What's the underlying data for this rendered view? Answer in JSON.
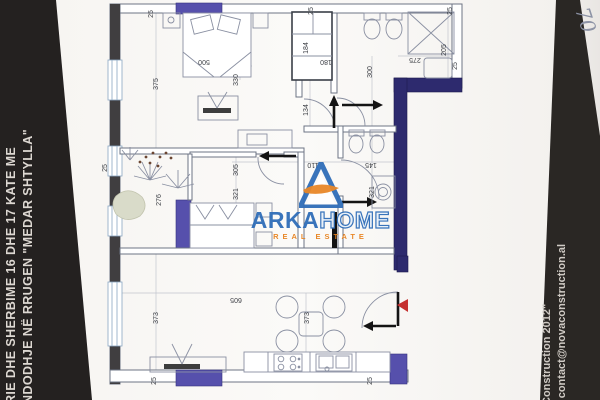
{
  "left_banner": {
    "line1": "RIE DHE SHERBIME 16 DHE 17 KATE ME",
    "line2": "NDODHJE NË RRUGEN \"MEDAR SHTYLLA\""
  },
  "right_banner": {
    "line1": "Construction 2012\"",
    "line2": ": contact@novaconstruction.al"
  },
  "handwritten_note": "70",
  "watermark": {
    "brand_primary": "ARKA",
    "brand_secondary": "HOME",
    "tagline": "REAL ESTATE",
    "blue": "#2f6db8",
    "orange": "#e8821e"
  },
  "plan": {
    "dims": [
      {
        "v": "25"
      },
      {
        "v": "500"
      },
      {
        "v": "330"
      },
      {
        "v": "375"
      },
      {
        "v": "25"
      },
      {
        "v": "184"
      },
      {
        "v": "180"
      },
      {
        "v": "300"
      },
      {
        "v": "275"
      },
      {
        "v": "205"
      },
      {
        "v": "25"
      },
      {
        "v": "25"
      },
      {
        "v": "134"
      },
      {
        "v": "110"
      },
      {
        "v": "145"
      },
      {
        "v": "305"
      },
      {
        "v": "321"
      },
      {
        "v": "276"
      },
      {
        "v": "25"
      },
      {
        "v": "321"
      },
      {
        "v": "605"
      },
      {
        "v": "373"
      },
      {
        "v": "373"
      },
      {
        "v": "25"
      },
      {
        "v": "25"
      }
    ]
  }
}
